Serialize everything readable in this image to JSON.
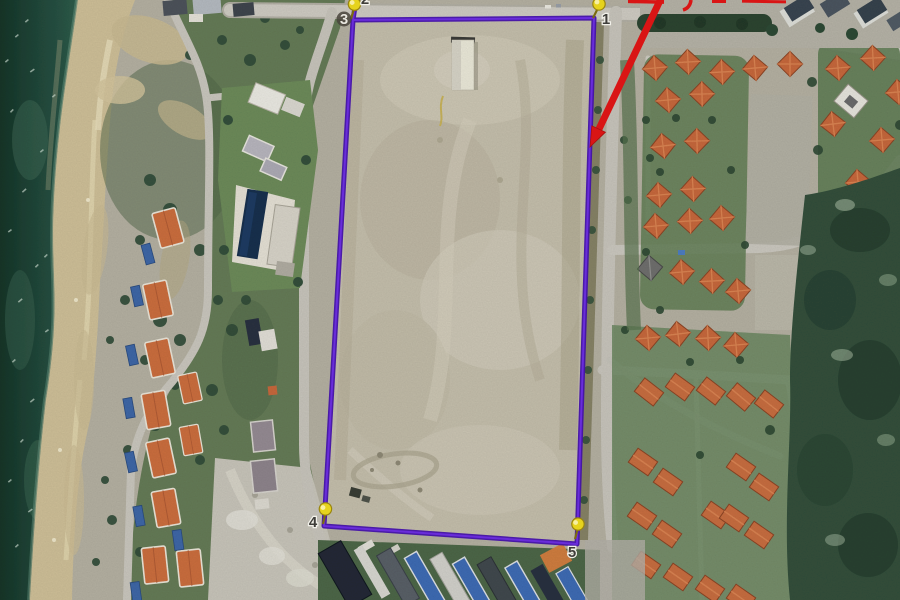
{
  "map": {
    "type": "annotated-satellite-image",
    "annotations": {
      "boundary_color": "#5a16c4",
      "arrow_color": "#d91515",
      "pushpin_color": "#e6d31d"
    },
    "vertices": [
      {
        "label": "1"
      },
      {
        "label": "2"
      },
      {
        "label": "3"
      },
      {
        "label": "4"
      },
      {
        "label": "5"
      }
    ]
  }
}
